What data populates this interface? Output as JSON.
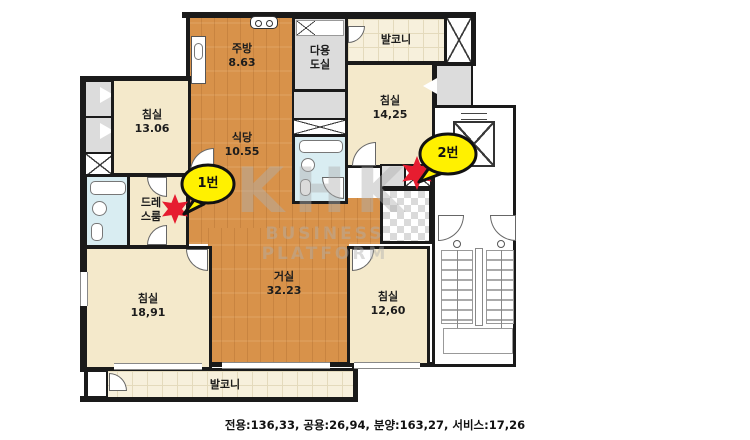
{
  "caption": "전용:136,33, 공용:26,94, 분양:163,27, 서비스:17,26",
  "watermark": {
    "brand": "KHK",
    "subtitle": "BUSINESS PLATFORM"
  },
  "markers": {
    "m1": "1번",
    "m2": "2번"
  },
  "rooms": {
    "kitchen": {
      "name": "주방",
      "area": "8.63"
    },
    "dining": {
      "name": "식당",
      "area": "10.55"
    },
    "utility": {
      "line1": "다용",
      "line2": "도실"
    },
    "balcony_top": {
      "name": "발코니"
    },
    "balcony_bottom": {
      "name": "발코니"
    },
    "bedroom_top_left": {
      "name": "침실",
      "area": "13.06"
    },
    "bedroom_top_right": {
      "name": "침실",
      "area": "14,25"
    },
    "bedroom_bottom_left": {
      "name": "침실",
      "area": "18,91"
    },
    "bedroom_bottom_right": {
      "name": "침실",
      "area": "12,60"
    },
    "living": {
      "name": "거실",
      "area": "32.23"
    },
    "dressroom": {
      "line1": "드레",
      "line2": "스룸"
    }
  },
  "colors": {
    "wall": "#1a1a1a",
    "bedroom_cream": "#F4E9CB",
    "wood_orange": "#D8924A",
    "balcony_tile": "#F7F0DC",
    "bathroom_blue": "#D9EDF2",
    "closet_gray": "#DCDCDC",
    "marker_yellow": "#FFF100",
    "marker_red": "#E61D30"
  }
}
